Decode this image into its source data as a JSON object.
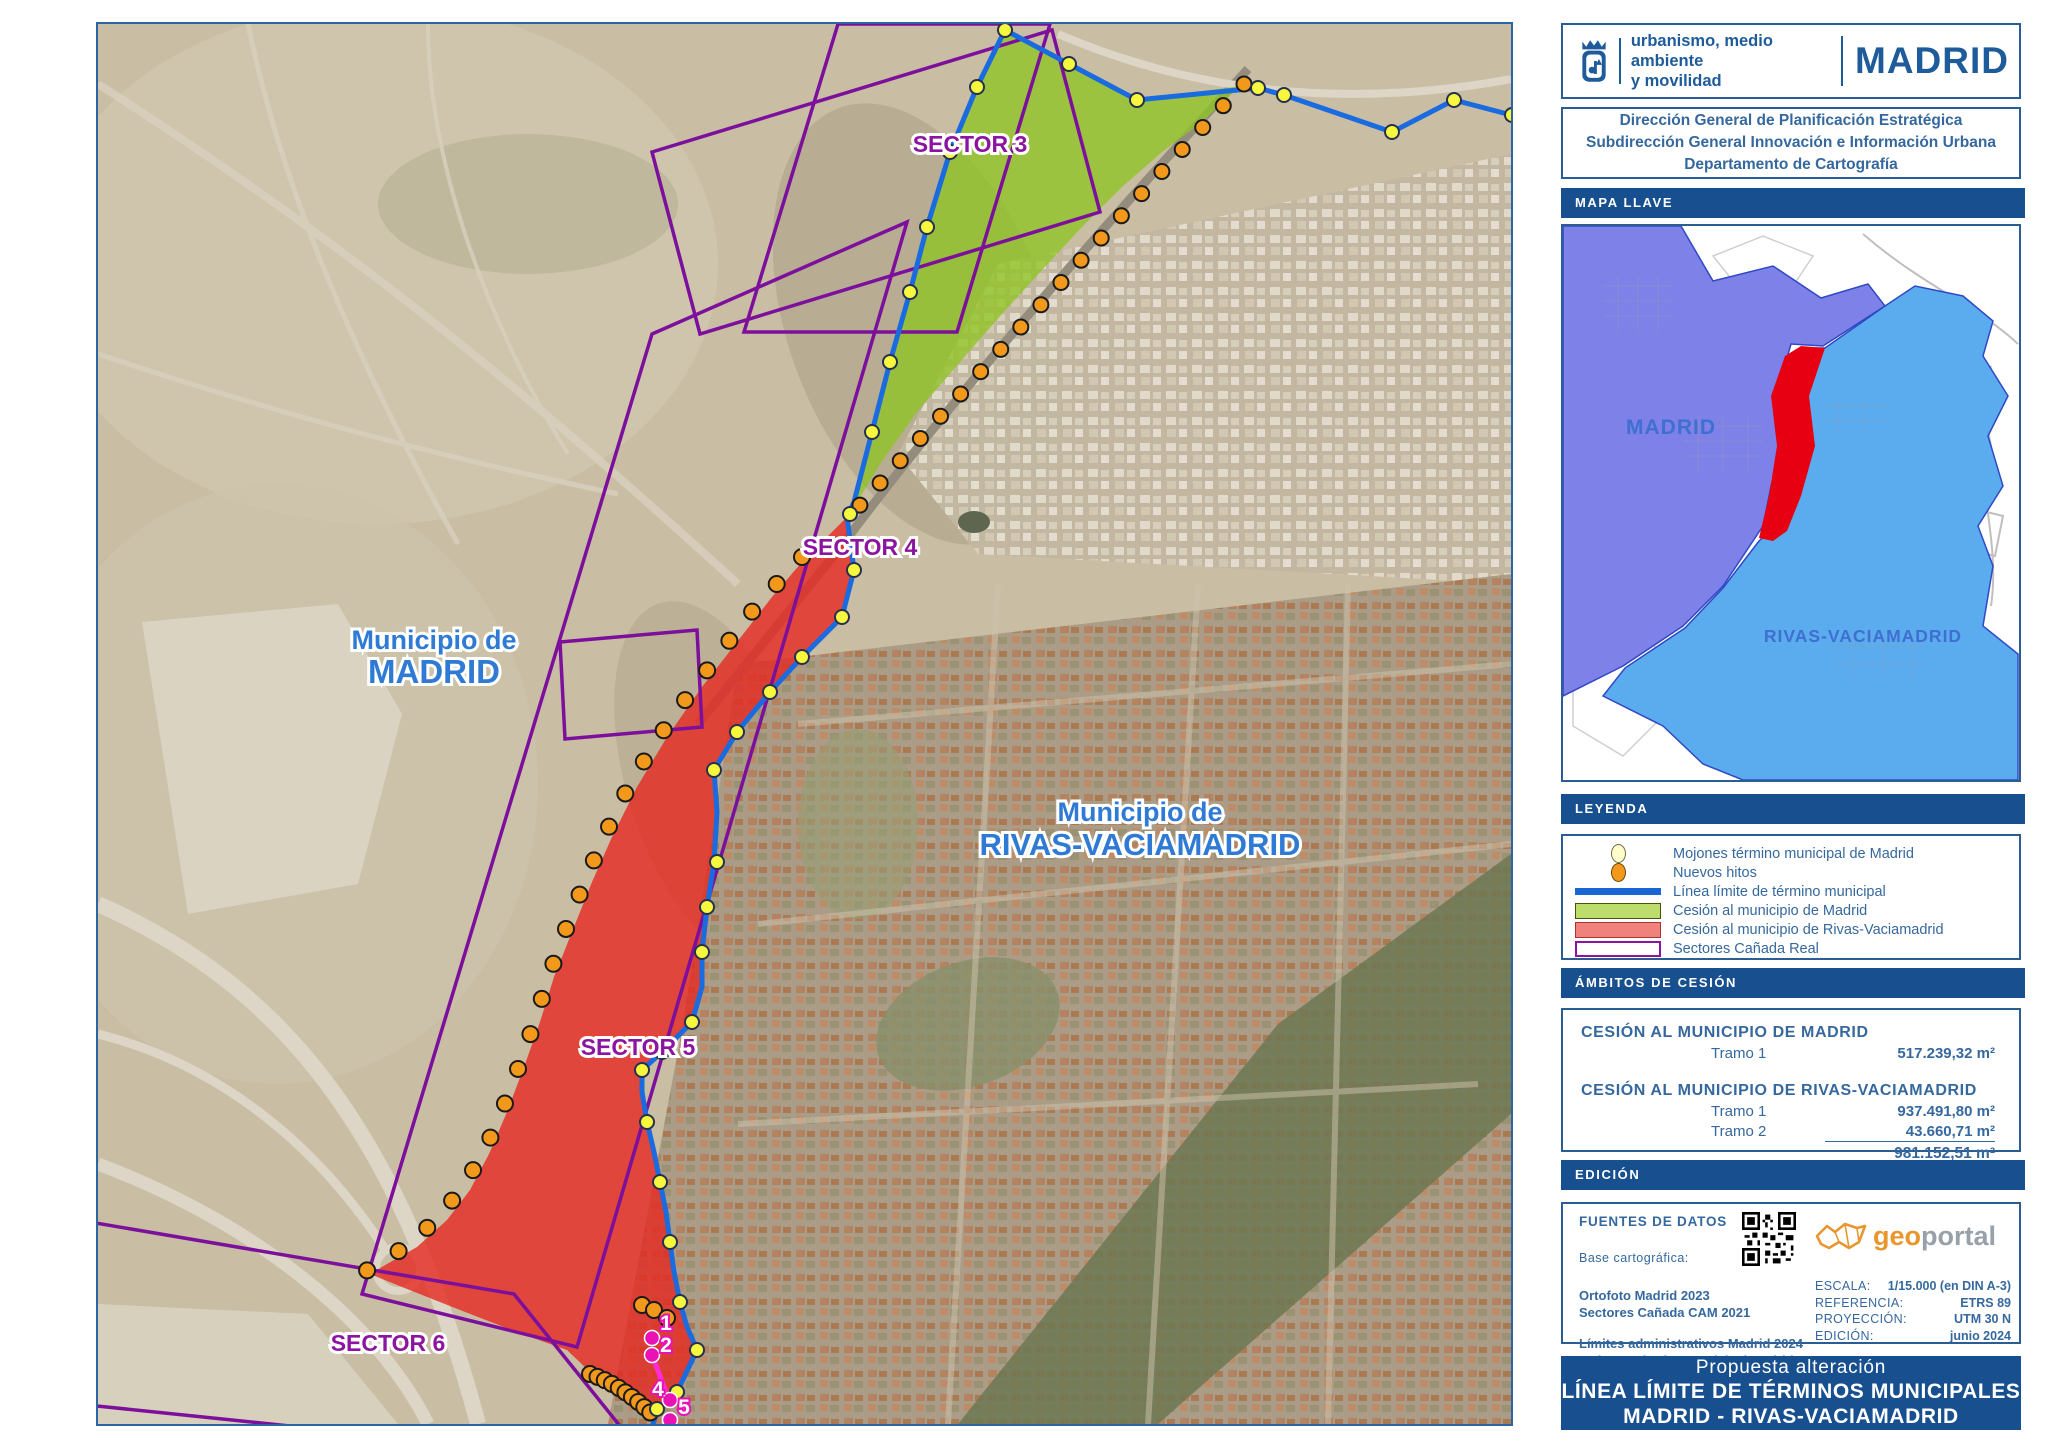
{
  "map": {
    "labels": {
      "municipio_madrid_1": "Municipio de",
      "municipio_madrid_2": "MADRID",
      "municipio_rivas_1": "Municipio de",
      "municipio_rivas_2": "RIVAS-VACIAMADRID",
      "sector3": "SECTOR 3",
      "sector4": "SECTOR 4",
      "sector5": "SECTOR 5",
      "sector6": "SECTOR 6",
      "point_labels": [
        "1",
        "2",
        "4",
        "5"
      ]
    }
  },
  "sidebar": {
    "logo": {
      "department_line1": "urbanismo, medio ambiente",
      "department_line2": "y movilidad",
      "city": "MADRID"
    },
    "org": [
      "Dirección General de Planificación Estratégica",
      "Subdirección General Innovación e Información Urbana",
      "Departamento de Cartografía"
    ],
    "sections": {
      "mapa_llave": "MAPA LLAVE",
      "leyenda": "LEYENDA",
      "ambitos": "ÁMBITOS DE CESIÓN",
      "edicion": "EDICIÓN"
    },
    "keymap": {
      "madrid": "MADRID",
      "rivas": "RIVAS-VACIAMADRID"
    },
    "legend": [
      {
        "symbol": "mojon-icon",
        "label": "Mojones término municipal de Madrid"
      },
      {
        "symbol": "hito-icon",
        "label": "Nuevos hitos"
      },
      {
        "symbol": "line-icon",
        "label": "Línea límite de término municipal"
      },
      {
        "symbol": "green-icon",
        "label": "Cesión al municipio de Madrid"
      },
      {
        "symbol": "red-icon",
        "label": "Cesión al municipio de Rivas-Vaciamadrid"
      },
      {
        "symbol": "sector-icon",
        "label": "Sectores Cañada Real"
      }
    ],
    "ambitos": {
      "madrid_title": "CESIÓN AL MUNICIPIO DE MADRID",
      "madrid_tramo1_label": "Tramo 1",
      "madrid_tramo1_value": "517.239,32 m²",
      "rivas_title": "CESIÓN AL MUNICIPIO DE RIVAS-VACIAMADRID",
      "rivas_tramo1_label": "Tramo 1",
      "rivas_tramo1_value": "937.491,80 m²",
      "rivas_tramo2_label": "Tramo 2",
      "rivas_tramo2_value": "43.660,71 m²",
      "rivas_total": "981.152,51 m²"
    },
    "edicion": {
      "fuentes_title": "FUENTES DE DATOS",
      "base_label": "Base cartográfica:",
      "source1a": "Ortofoto Madrid 2023",
      "source1b": "Sectores Cañada CAM 2021",
      "source2a": "Límites administrativos Madrid 2024",
      "source2b": "Mojones término municipal Madrid",
      "geoportal_geo": "geo",
      "geoportal_portal": "portal",
      "escala_label": "ESCALA:",
      "escala_value": "1/15.000 (en DIN A-3)",
      "referencia_label": "REFERENCIA:",
      "referencia_value": "ETRS 89",
      "proyeccion_label": "PROYECCIÓN:",
      "proyeccion_value": "UTM 30 N",
      "edicion_label": "EDICIÓN:",
      "edicion_value": "junio 2024"
    },
    "footer": {
      "line1": "Propuesta alteración",
      "line2": "LÍNEA LÍMITE DE TÉRMINOS MUNICIPALES",
      "line3": "MADRID - RIVAS-VACIAMADRID"
    }
  },
  "colors": {
    "header_blue": "#174f8f",
    "text_blue": "#35689e",
    "logo_blue": "#1d5b9b",
    "boundary_blue": "#1b6be0",
    "sector_purple": "#8b15a0",
    "cession_green": "#96c424",
    "cession_red": "#e62820",
    "mojon_yellow": "#f7f73e",
    "hito_orange": "#f2991c",
    "keymap_madrid": "#7e81e8",
    "keymap_rivas": "#5aacee",
    "keymap_red": "#e60012",
    "geoportal_orange": "#e8962e"
  }
}
